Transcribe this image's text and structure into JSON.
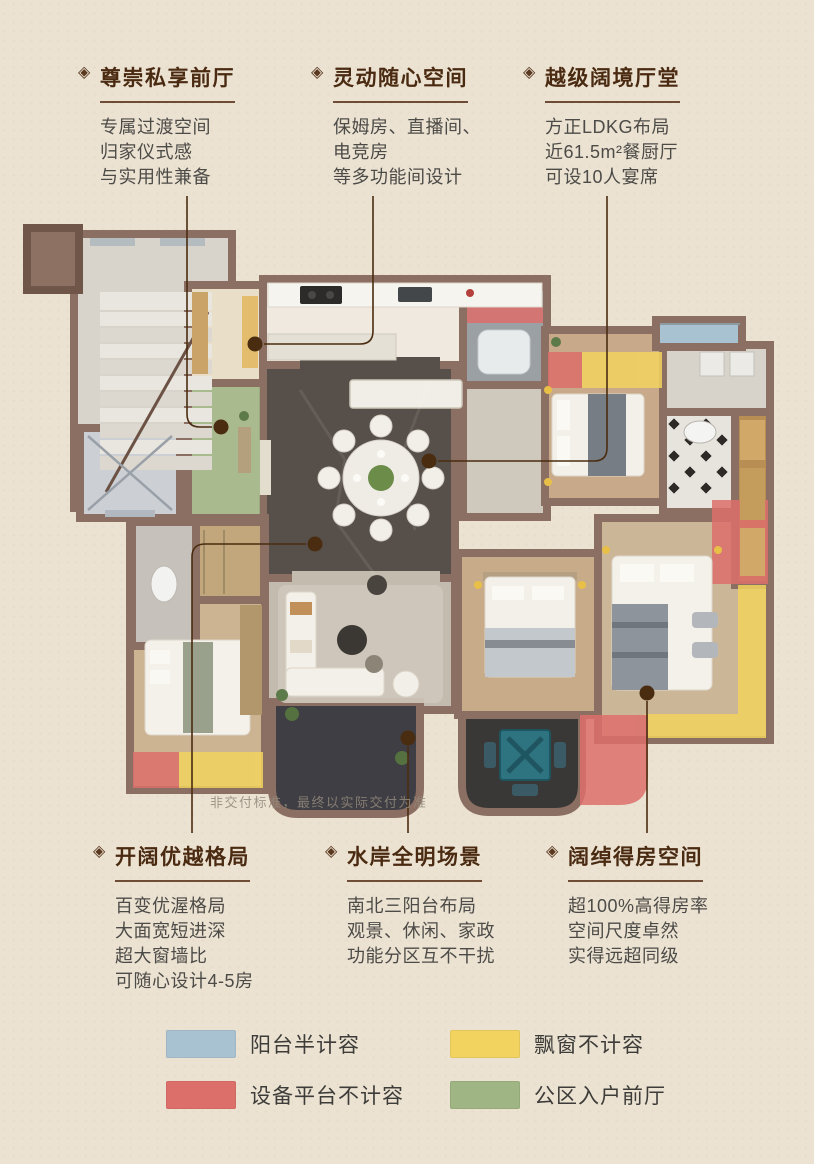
{
  "bullet": "◈",
  "disclaimer": "非交付标准，最终以实际交付为准",
  "callouts_top": [
    {
      "title": "尊崇私享前厅",
      "lines": [
        "专属过渡空间",
        "归家仪式感",
        "与实用性兼备"
      ]
    },
    {
      "title": "灵动随心空间",
      "lines": [
        "保姆房、直播间、",
        "电竞房",
        "等多功能间设计"
      ]
    },
    {
      "title": "越级阔境厅堂",
      "lines": [
        "方正LDKG布局",
        "近61.5m²餐厨厅",
        "可设10人宴席"
      ]
    }
  ],
  "callouts_bottom": [
    {
      "title": "开阔优越格局",
      "lines": [
        "百变优渥格局",
        "大面宽短进深",
        "超大窗墙比",
        "可随心设计4-5房"
      ]
    },
    {
      "title": "水岸全明场景",
      "lines": [
        "南北三阳台布局",
        "观景、休闲、家政",
        "功能分区互不干扰"
      ]
    },
    {
      "title": "阔绰得房空间",
      "lines": [
        "超100%高得房率",
        "空间尺度卓然",
        "实得远超同级"
      ]
    }
  ],
  "legend": [
    {
      "label": "阳台半计容",
      "color": "#a9c2d2"
    },
    {
      "label": "飘窗不计容",
      "color": "#f2d35f"
    },
    {
      "label": "设备平台不计容",
      "color": "#dd6f6b"
    },
    {
      "label": "公区入户前厅",
      "color": "#9fb583"
    }
  ],
  "colors": {
    "title_brown": "#4a2a11",
    "leader_line": "#4a2c10",
    "wall": "#8b6f62",
    "background": "#ebe2d2"
  }
}
